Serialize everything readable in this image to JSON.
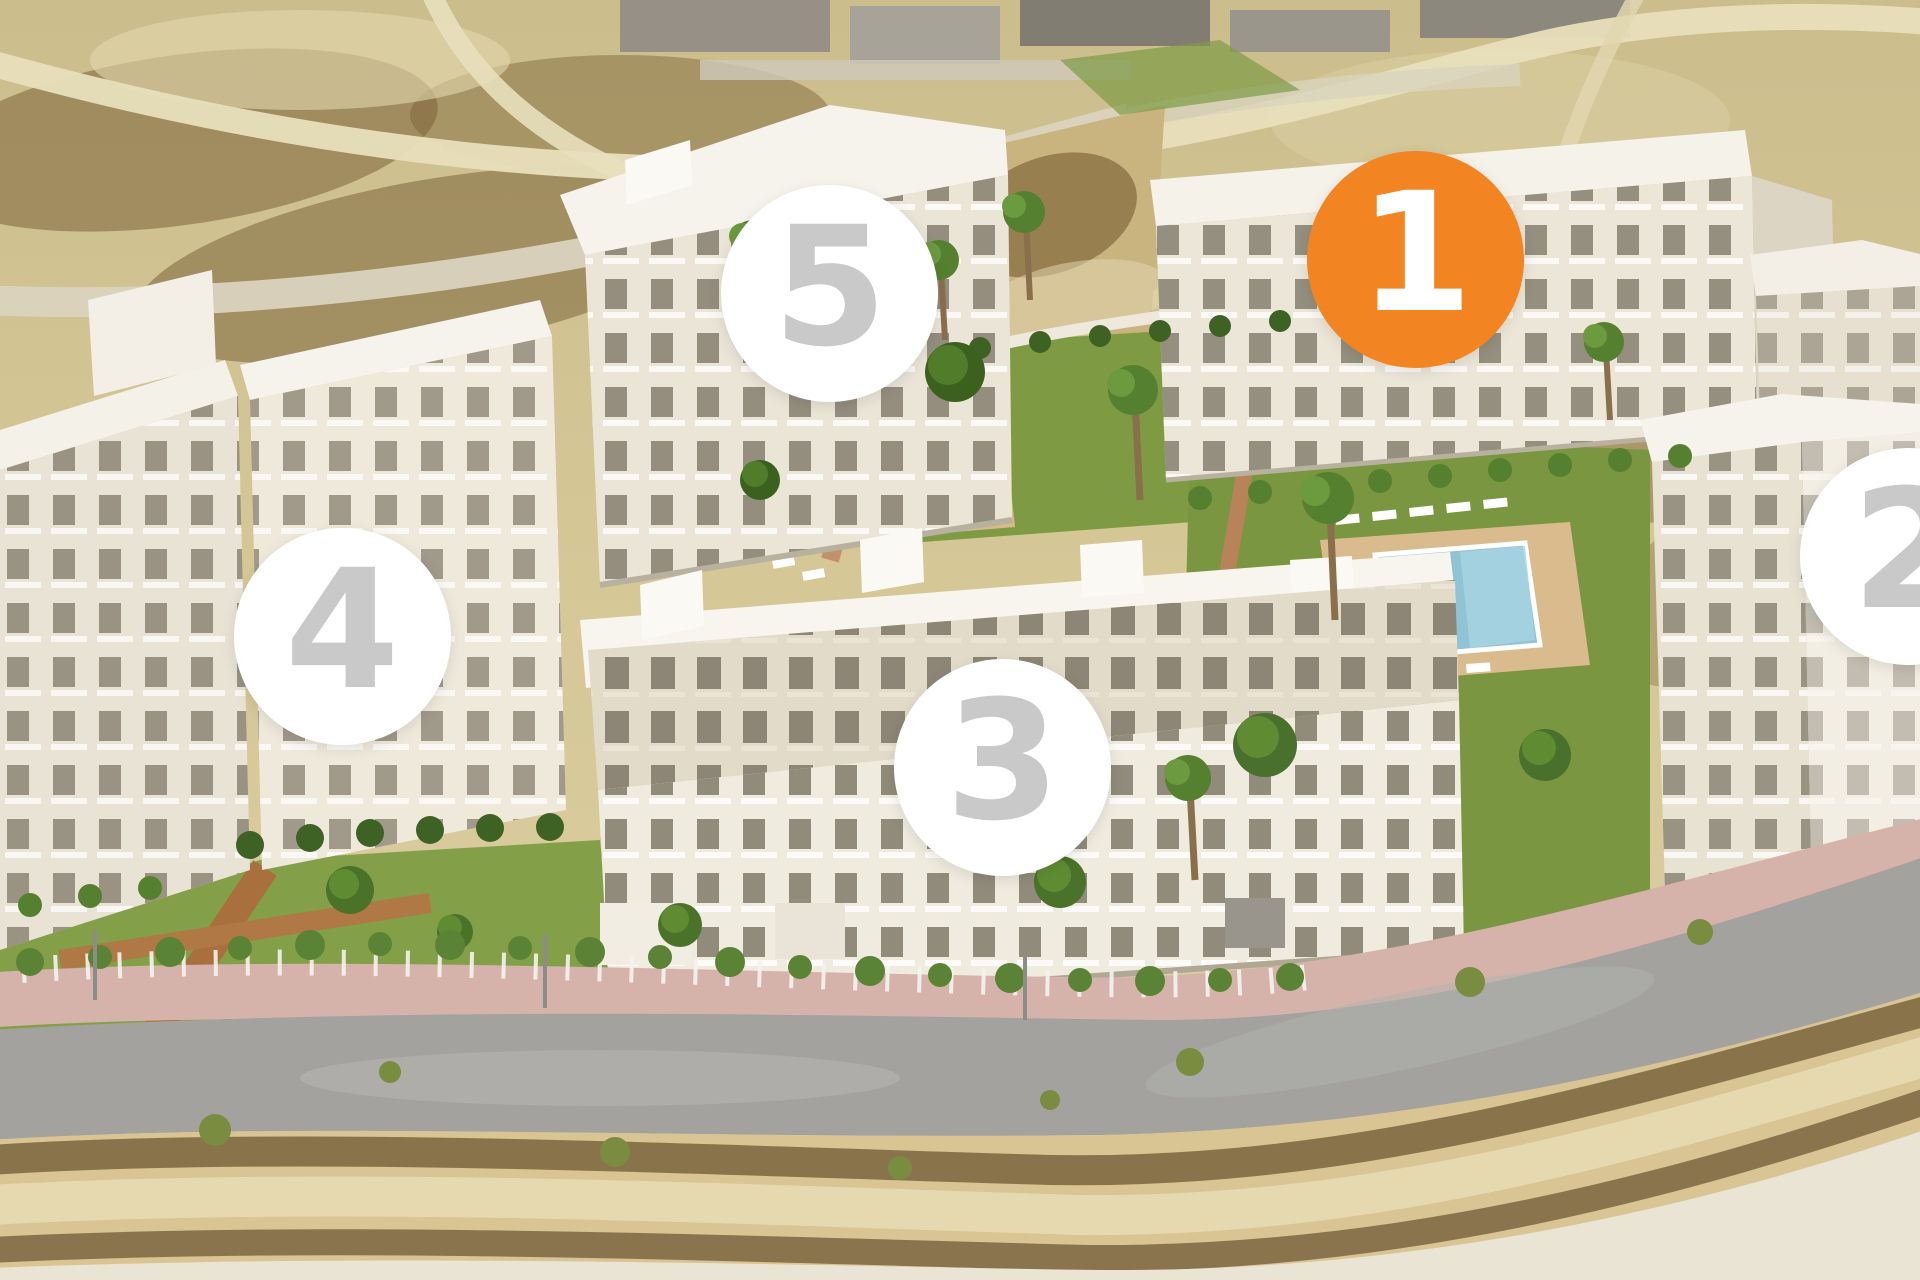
{
  "scene": {
    "markers": [
      {
        "id": "building-1",
        "label": "1",
        "highlighted": true,
        "x_pct": 73.7,
        "y_pct": 20.2
      },
      {
        "id": "building-2",
        "label": "2",
        "highlighted": false,
        "x_pct": 99.4,
        "y_pct": 43.4
      },
      {
        "id": "building-3",
        "label": "3",
        "highlighted": false,
        "x_pct": 52.2,
        "y_pct": 59.9
      },
      {
        "id": "building-4",
        "label": "4",
        "highlighted": false,
        "x_pct": 17.8,
        "y_pct": 49.7
      },
      {
        "id": "building-5",
        "label": "5",
        "highlighted": false,
        "x_pct": 43.2,
        "y_pct": 22.9
      }
    ],
    "colors": {
      "marker_highlight_bg": "#F28422",
      "marker_highlight_text": "#FFFFFF",
      "marker_default_bg": "#FFFFFF",
      "marker_default_text": "#C9C9C9"
    }
  }
}
